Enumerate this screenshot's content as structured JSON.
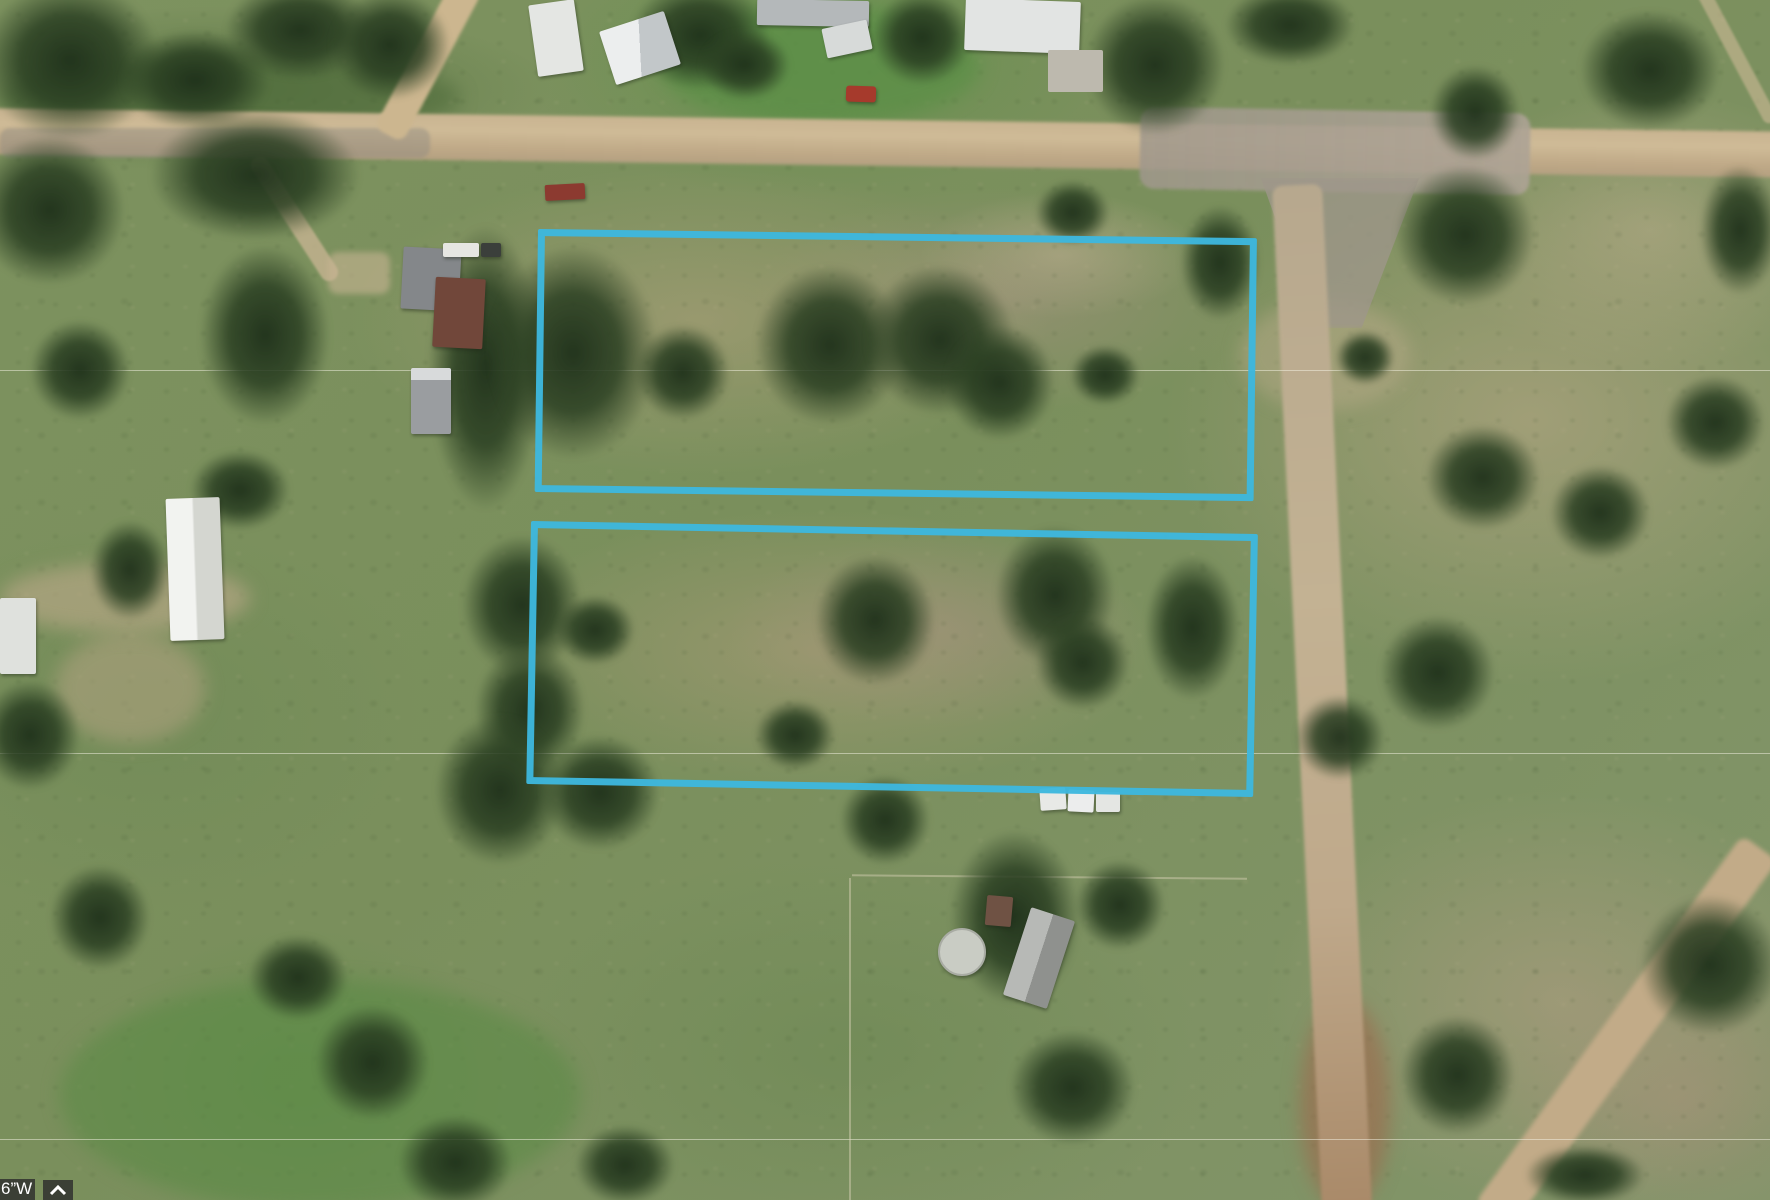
{
  "view": {
    "type": "aerial-satellite-map",
    "description": "Satellite imagery of rural land with dirt roads, trees, farm buildings and two lots outlined in blue"
  },
  "hud": {
    "coordinate_fragment": "6”W",
    "collapse_button_icon": "chevron-up",
    "bar_color": "rgba(45,45,45,0.82)",
    "text_color": "#ffffff"
  },
  "overlay": {
    "outline_color": "#3db7de",
    "outline_width_px": 7,
    "parcels": [
      {
        "id": "parcel-north",
        "left": 538,
        "top": 229,
        "width": 719,
        "height": 263,
        "rotation_deg": 0.73
      },
      {
        "id": "parcel-south",
        "left": 531,
        "top": 521,
        "width": 727,
        "height": 263,
        "rotation_deg": 1.03
      }
    ]
  }
}
